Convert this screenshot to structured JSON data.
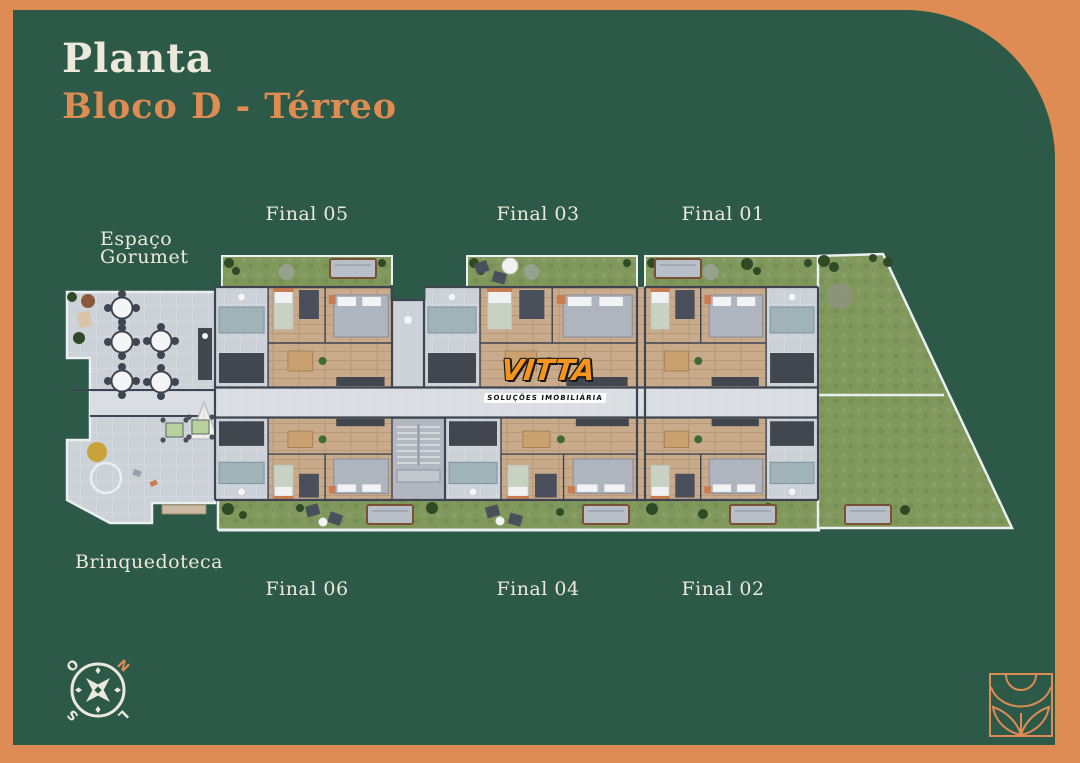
{
  "title": {
    "line1": "Planta",
    "line2": "Bloco D - Térreo"
  },
  "labels": {
    "espaco_line1": "Espaço",
    "espaco_line2": "Gorumet",
    "brinquedoteca": "Brinquedoteca"
  },
  "units": [
    {
      "id": "final-05",
      "label": "Final 05"
    },
    {
      "id": "final-03",
      "label": "Final 03"
    },
    {
      "id": "final-01",
      "label": "Final 01"
    },
    {
      "id": "final-06",
      "label": "Final 06"
    },
    {
      "id": "final-04",
      "label": "Final 04"
    },
    {
      "id": "final-02",
      "label": "Final 02"
    }
  ],
  "compass": {
    "north": "N",
    "south": "S",
    "east": "L",
    "west": "O"
  },
  "logo": {
    "brand": "VITTA",
    "tagline": "SOLUÇÕES IMOBILIÁRIA"
  },
  "colors": {
    "background_orange": "#DE8B54",
    "panel_green": "#2C5948",
    "cream": "#EDE8DC",
    "title_orange": "#DE8C52",
    "grass": "#80985C",
    "grass_light": "#8FA96A",
    "bush": "#2E4A26",
    "wood": "#C9AA8B",
    "wall": "#3E4450",
    "floor": "#CDD1D8",
    "floor_light": "#DADDE2",
    "white_wall": "#ECEFF2",
    "counter": "#41464F",
    "furniture": "#B9BFC8",
    "accent": "#C97C52",
    "stair": "#B2B7C0",
    "logo_orange": "#F7941E"
  }
}
